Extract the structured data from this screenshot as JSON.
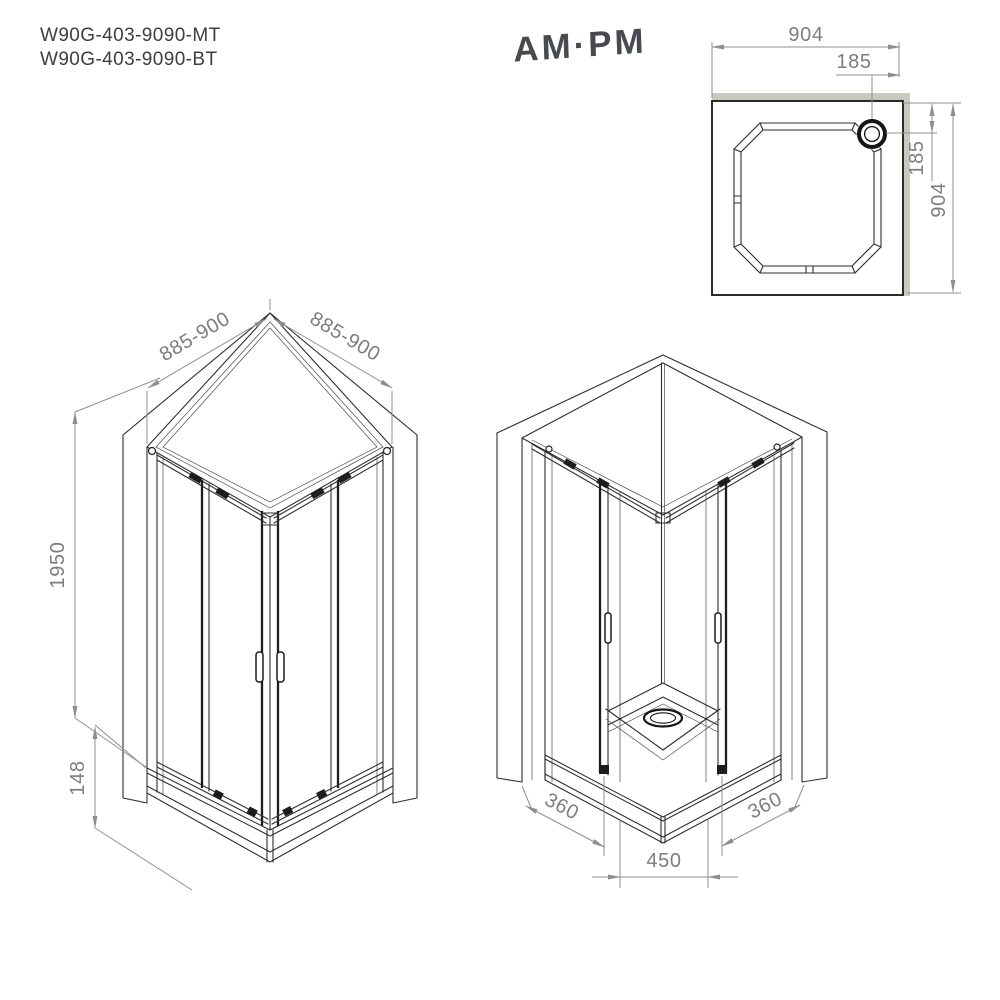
{
  "header": {
    "model_codes": [
      "W90G-403-9090-MT",
      "W90G-403-9090-BT"
    ],
    "brand_logo": "AM·PM"
  },
  "top_view": {
    "title": "shower tray plan view",
    "dims": {
      "width": "904",
      "depth": "904",
      "drain_offset_from_right": "185",
      "drain_offset_from_top": "185"
    }
  },
  "front_view": {
    "title": "enclosure isometric outside view",
    "dims": {
      "side_width_left": "885-900",
      "side_width_right": "885-900",
      "height": "1950",
      "tray_height": "148"
    }
  },
  "corner_view": {
    "title": "enclosure isometric corner-entry view",
    "dims": {
      "door_opening_left": "360",
      "door_opening_right": "360",
      "entry_width": "450"
    }
  },
  "colors": {
    "drawing_line": "#2e2e2e",
    "dimension_line": "#8f8f8f",
    "dimension_text": "#7d7d7d",
    "wall_strip": "#cac9c1",
    "model_text": "#3e3e3e",
    "logo_text": "#474b4f"
  }
}
